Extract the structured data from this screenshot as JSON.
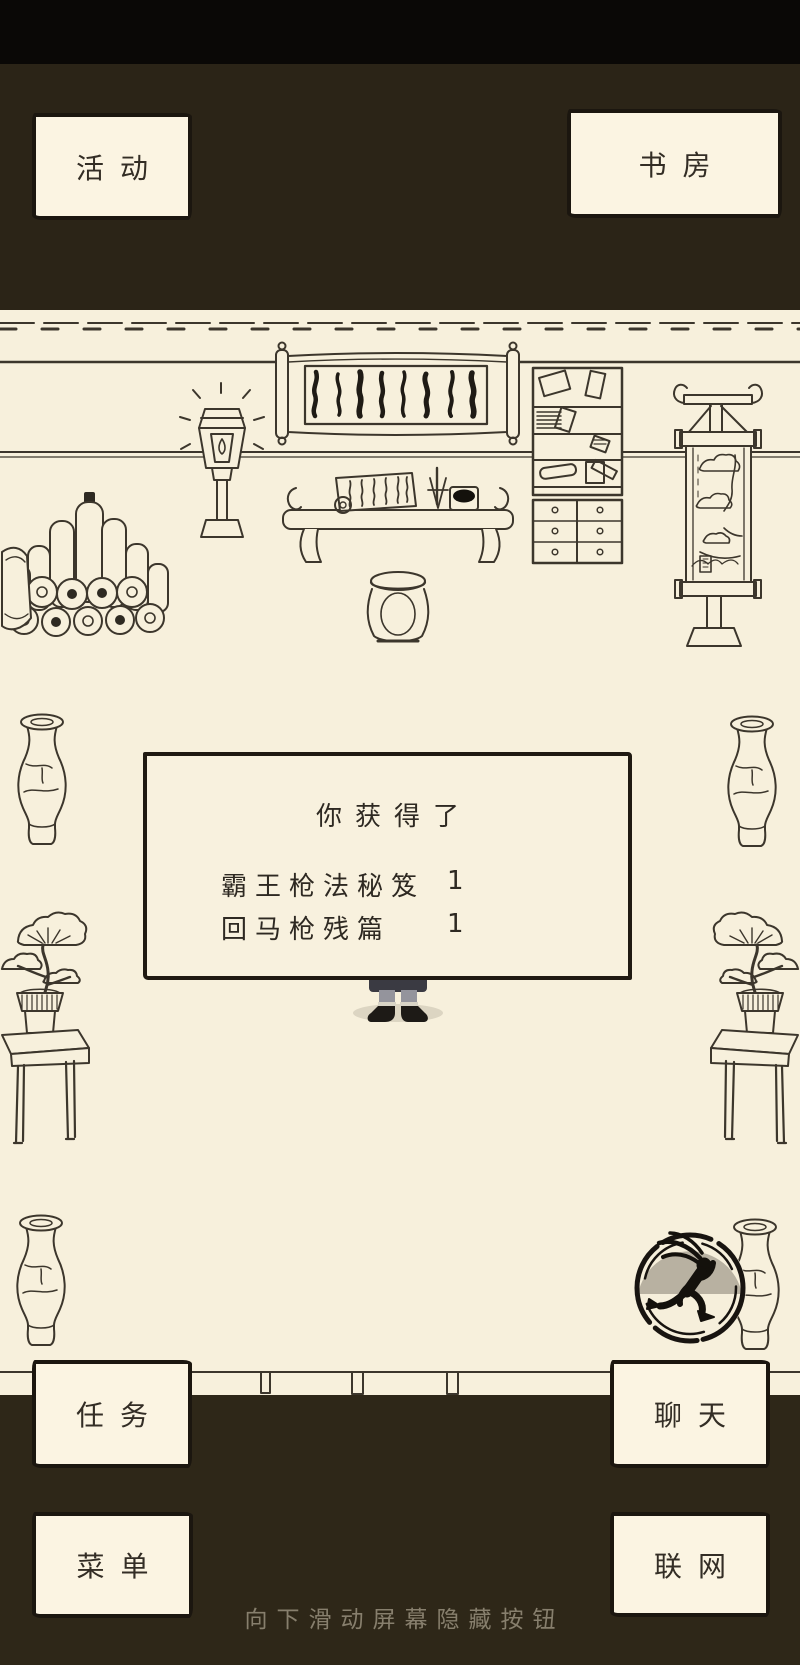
{
  "top_buttons": {
    "activity": "活动",
    "study": "书房"
  },
  "bottom_buttons": {
    "tasks": "任务",
    "chat": "聊天",
    "menu": "菜单",
    "network": "联网"
  },
  "dialog": {
    "title": "你获得了",
    "items": [
      {
        "name": "霸王枪法秘笈",
        "count": "1"
      },
      {
        "name": "回马枪残篇",
        "count": "1"
      }
    ]
  },
  "hint": {
    "text": "向下滑动屏幕隐藏按钮"
  },
  "icons": {
    "run_icon": "running-figure-toggle"
  },
  "colors": {
    "cream": "#f7f0dc",
    "dark_brown": "#2b2417",
    "top_black": "#0a0806",
    "ink": "#3c362c",
    "button_bg": "#fbf4e2",
    "border_ink": "#1b160f",
    "run_icon_gray": "#b8b1a1",
    "hint_text": "#877f6d"
  }
}
